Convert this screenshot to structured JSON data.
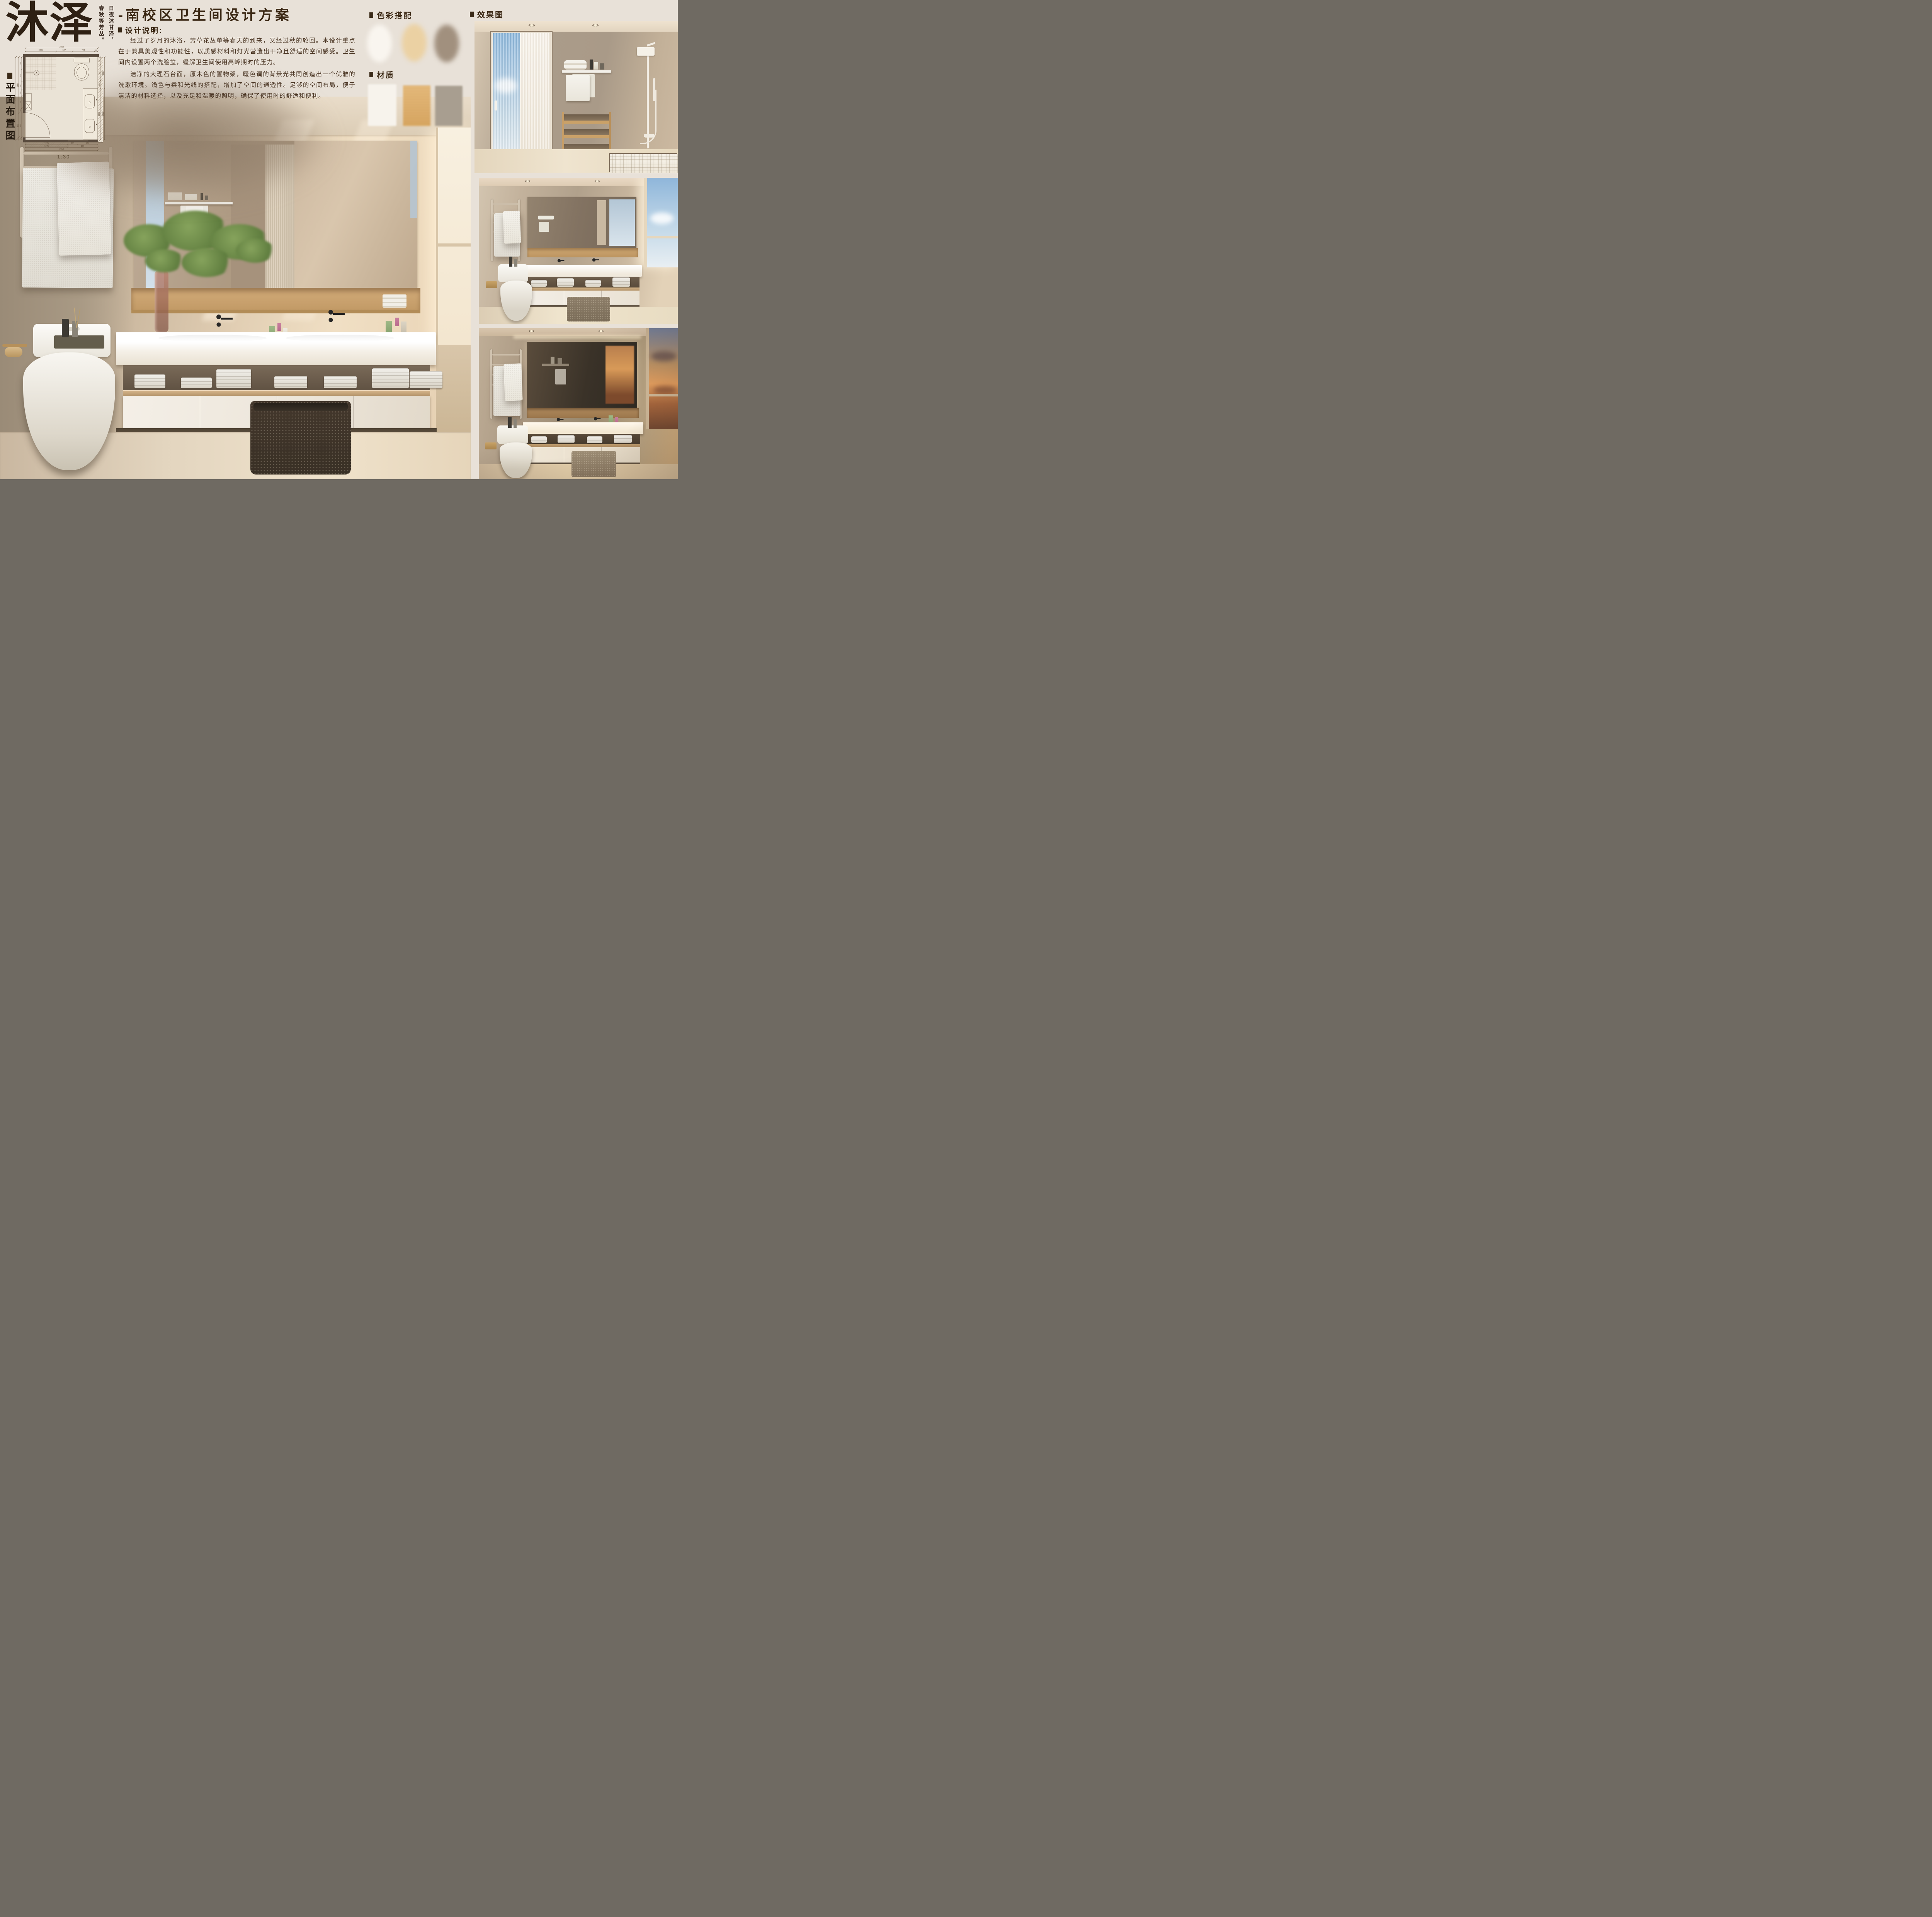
{
  "poster": {
    "bg": "#e8e1d8",
    "accent": "#3a2a18"
  },
  "logo": {
    "text": "沐泽",
    "tagline_right": "日夜沐甘泽，",
    "tagline_left": "春秋等芳丛。"
  },
  "plan": {
    "label": "平面布置图",
    "scale_label": "1:30",
    "dims": {
      "top_overall": "2350",
      "top": [
        "1000",
        "527",
        "723",
        "100"
      ],
      "left_outer": "2690",
      "left_mid": [
        "1810",
        "800",
        "80"
      ],
      "left_inner": [
        "400",
        "400",
        "260",
        "200",
        "400",
        "150",
        "800",
        "80"
      ],
      "right_inner": [
        "255",
        "511",
        "255",
        "1670"
      ],
      "right_outer": [
        "1020",
        "1670"
      ],
      "bottom1": [
        "1370",
        "330",
        "650"
      ],
      "bottom2": [
        "1370",
        "980"
      ],
      "bottom_overall": "2350"
    }
  },
  "header": {
    "title": "-南校区卫生间设计方案",
    "design_label": "设计说明:",
    "para1": "经过了岁月的沐浴，芳草花丛单等春天的到来，又经过秋的轮回。本设计重点在于兼具美观性和功能性，以质感材料和灯光营造出干净且舒适的空间感受。卫生间内设置两个洗脸盆，缓解卫生间使用高峰期时的压力。",
    "para2": "洁净的大理石台面，原木色的置物架，暖色调的背景光共同创造出一个优雅的洗漱环境。浅色与柔和光线的搭配，增加了空间的通透性。足够的空间布局，便于清洁的材料选择，以及充足和温暖的照明，确保了使用时的舒适和便利。"
  },
  "palette": {
    "label": "色彩搭配",
    "colors": [
      "#f9f5ef",
      "#ebd1a3",
      "#a1907e"
    ]
  },
  "materials": {
    "label": "材质",
    "colors": [
      "#f7f3ec",
      "#e0ae6c",
      "#a89e90"
    ]
  },
  "renders": {
    "label": "效果图"
  }
}
